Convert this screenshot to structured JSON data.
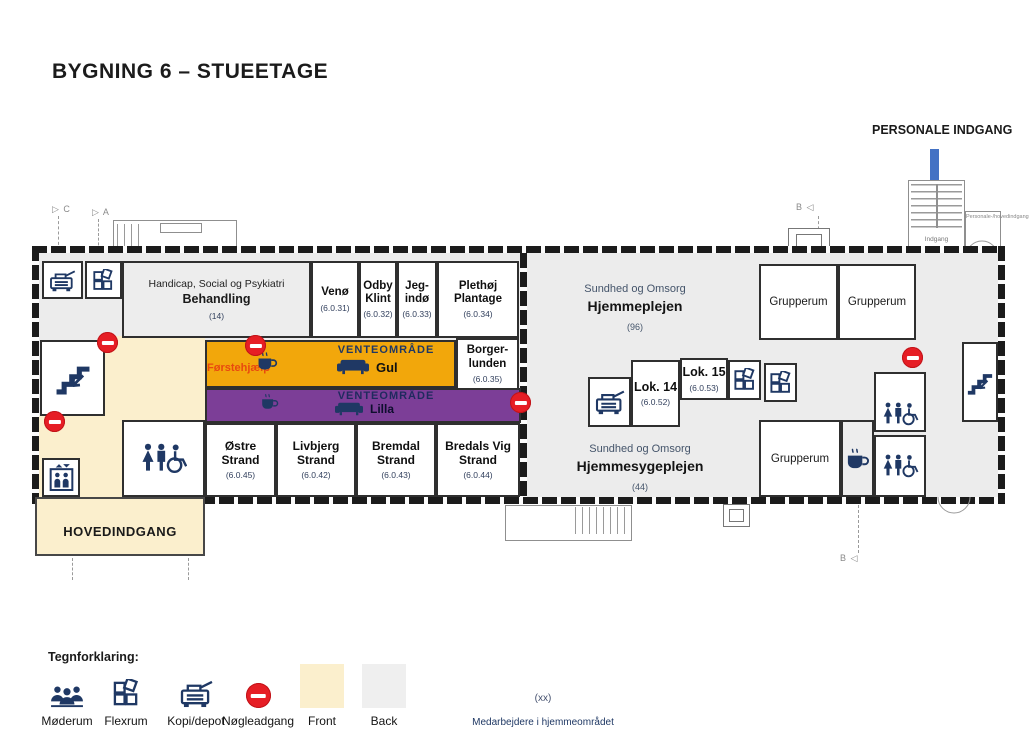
{
  "title": "BYGNING 6 – STUEETAGE",
  "personale": {
    "label": "PERSONALE INDGANG",
    "indgang": "Indgang",
    "note": "Personale-/hovedindgang"
  },
  "markers": {
    "c": "▷ C",
    "a": "▷ A",
    "b_top": "B ◁",
    "b_bottom": "B ◁"
  },
  "rooms": {
    "behandling": {
      "line1": "Handicap, Social og Psykiatri",
      "line2": "Behandling",
      "count": "(14)"
    },
    "venoe": {
      "name": "Venø",
      "num": "(6.0.31)"
    },
    "odby_klint": {
      "name": "Odby Klint",
      "num": "(6.0.32)"
    },
    "jegindoe": {
      "name": "Jeg-indø",
      "num": "(6.0.33)"
    },
    "plethoej_plantage": {
      "name": "Plethøj Plantage",
      "num": "(6.0.34)"
    },
    "borgerlunden": {
      "name": "Borger-lunden",
      "num": "(6.0.35)"
    },
    "oestre_strand": {
      "name": "Østre Strand",
      "num": "(6.0.45)"
    },
    "livbjerg_strand": {
      "name": "Livbjerg Strand",
      "num": "(6.0.42)"
    },
    "bremdal_strand": {
      "name": "Bremdal Strand",
      "num": "(6.0.43)"
    },
    "bredals_vig_strand": {
      "name": "Bredals Vig Strand",
      "num": "(6.0.44)"
    },
    "lok14": {
      "name": "Lok. 14",
      "num": "(6.0.52)"
    },
    "lok15": {
      "name": "Lok. 15",
      "num": "(6.0.53)"
    },
    "hjemmeplejen": {
      "line1": "Sundhed og Omsorg",
      "line2": "Hjemmeplejen",
      "count": "(96)"
    },
    "hjemmesygeplejen": {
      "line1": "Sundhed og Omsorg",
      "line2": "Hjemmesygeplejen",
      "count": "(44)"
    },
    "grupperum": "Grupperum",
    "hovedindgang": "HOVEDINDGANG"
  },
  "zones": {
    "gul": {
      "venteomraade": "VENTEOMRÅDE",
      "name": "Gul",
      "foerstehjaelp": "Førstehjælp",
      "color": "#F2A70B"
    },
    "lilla": {
      "venteomraade": "VENTEOMRÅDE",
      "name": "Lilla",
      "color": "#7C3E97"
    }
  },
  "legend": {
    "title": "Tegnforklaring:",
    "items": [
      {
        "icon": "meeting-icon",
        "label": "Møderum"
      },
      {
        "icon": "flexroom-icon",
        "label": "Flexrum"
      },
      {
        "icon": "copier-icon",
        "label": "Kopi/depot"
      },
      {
        "icon": "no-entry-icon",
        "label": "Nøgleadgang"
      },
      {
        "icon": "front-swatch",
        "label": "Front",
        "color": "#FBEFCD"
      },
      {
        "icon": "back-swatch",
        "label": "Back",
        "color": "#EFEFEF"
      }
    ],
    "staff_symbol": "(xx)",
    "staff_label": "Medarbejdere i hjemmeområdet"
  },
  "colors": {
    "front": "#FBEFCD",
    "back": "#ECECEC",
    "gul": "#F2A70B",
    "lilla": "#7C3E97",
    "icon_navy": "#1F3864",
    "no_entry_red": "#E61E25",
    "arrow_blue": "#4472C4",
    "foerstehjaelp_text": "#E8490F",
    "wall": "#1b1b1b"
  }
}
